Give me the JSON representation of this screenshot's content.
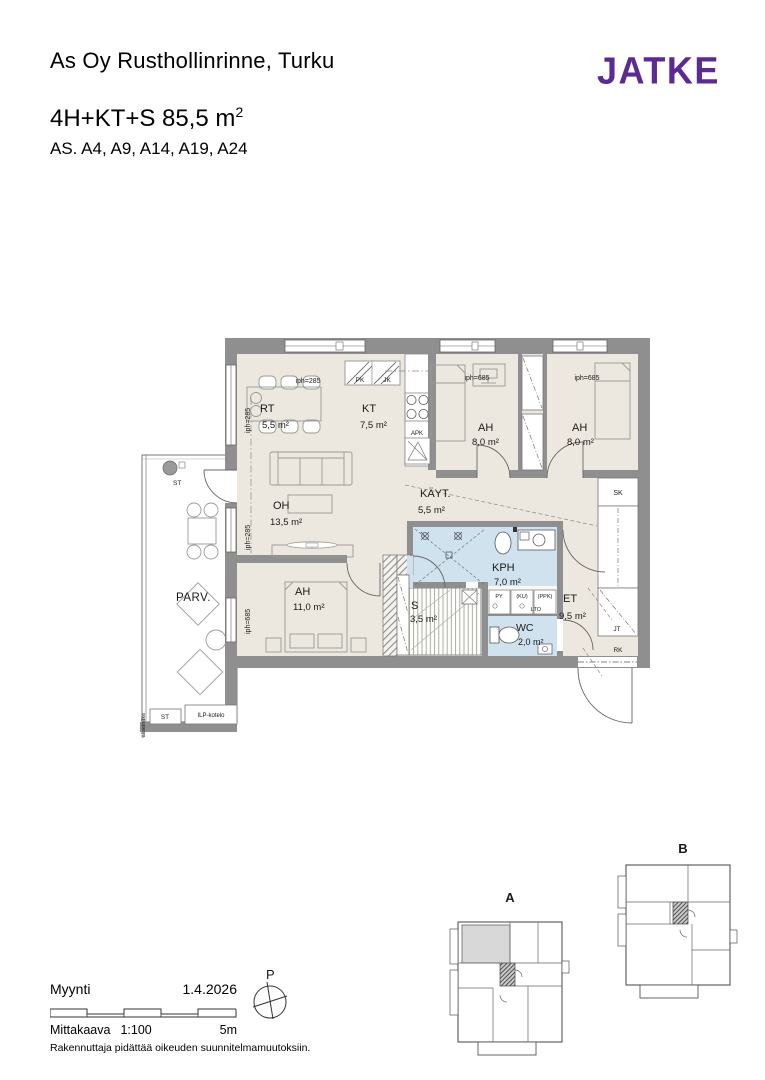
{
  "header": {
    "project": "As Oy Rusthollinrinne, Turku",
    "logo": "JATKE",
    "type_line": "4H+KT+S 85,5 m",
    "type_sup": "2",
    "units_line": "AS. A4, A9, A14, A19, A24"
  },
  "plan": {
    "rooms": {
      "rt": {
        "name": "RT",
        "area": "5,5 m²"
      },
      "kt": {
        "name": "KT",
        "area": "7,5 m²"
      },
      "ah1": {
        "name": "AH",
        "area": "8,0 m²"
      },
      "ah2": {
        "name": "AH",
        "area": "8,0 m²"
      },
      "oh": {
        "name": "OH",
        "area": "13,5 m²"
      },
      "kayt": {
        "name": "KÄYT.",
        "area": "5,5 m²"
      },
      "kph": {
        "name": "KPH",
        "area": "7,0 m²"
      },
      "ah3": {
        "name": "AH",
        "area": "11,0 m²"
      },
      "s": {
        "name": "S",
        "area": "3,5 m²"
      },
      "et": {
        "name": "ET",
        "area": "9,5 m²"
      },
      "wc": {
        "name": "WC",
        "area": "2,0 m²"
      },
      "parv": {
        "name": "PARV."
      }
    },
    "labels": {
      "iph285": "iph=285",
      "iph685": "iph=685",
      "pk": "PK",
      "jk": "JK",
      "apk": "APK",
      "sk": "SK",
      "jt": "JT",
      "rk": "RK",
      "py": "PY",
      "ku": "(KU)",
      "ppk": "(PPK)",
      "lto": "LTO",
      "st": "ST",
      "ilp": "ILP-kotelo",
      "partition": "väliseinäke",
      "compass": "P"
    }
  },
  "keyplan": {
    "a": "A",
    "b": "B"
  },
  "footer": {
    "status": "Myynti",
    "date": "1.4.2026",
    "scale_word": "Mittakaava",
    "scale_value": "1:100",
    "scale_end": "5m",
    "disclaimer": "Rakennuttaja pidättää oikeuden suunnitelmamuutoksiin."
  },
  "colors": {
    "brand_purple": "#5b2b91",
    "wall_gray": "#8f8f8f",
    "floor_beige": "#ece8df",
    "wet_room_blue": "#cfe2ee"
  }
}
